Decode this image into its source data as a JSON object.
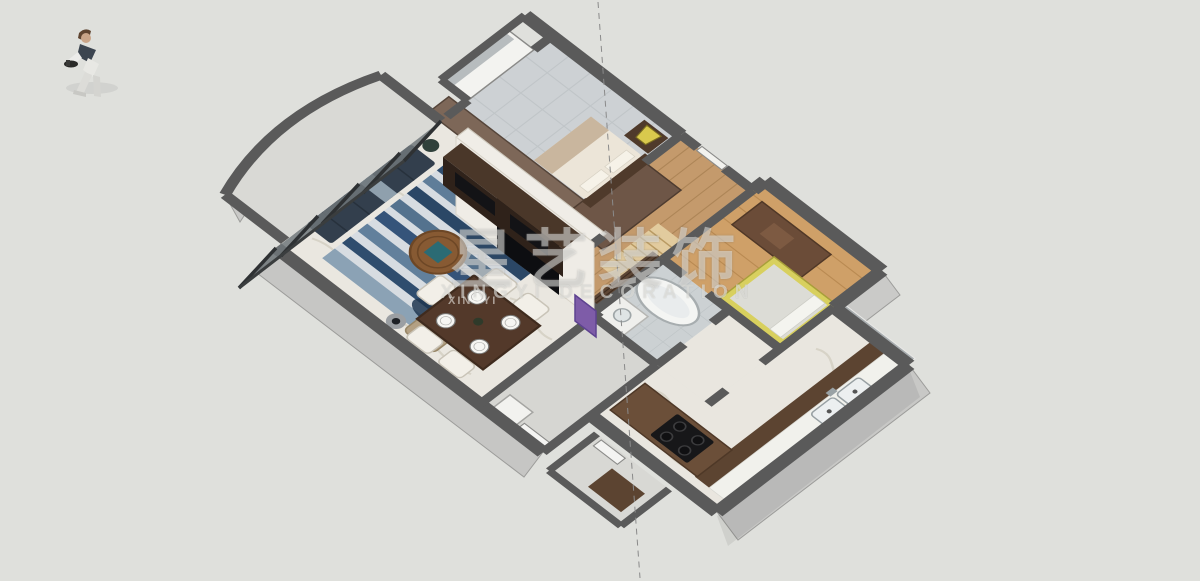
{
  "scene": {
    "type": "3d-apartment-cutaway-floorplan-render",
    "background": "#dfe0dc",
    "watermark": {
      "brand_cn": "星艺装饰",
      "brand_en": "XINGYI DECORATION",
      "small": "XINGYI"
    },
    "palette": {
      "wall_top": "#5a5a5a",
      "wall_face_light": "#c7c7c5",
      "glass": "#70777a",
      "floor_marble": "#eae7e0",
      "floor_wood": "#c99f6c",
      "floor_tile": "#cdd1d4",
      "rug_blue_dark": "#2b4766",
      "rug_blue_mid": "#5f7d99",
      "sofa_navy": "#333f4d",
      "cabinet_wood_dark": "#5c4431",
      "bulkhead_brown": "#7d6758",
      "counter_white": "#f1f1ec",
      "dining_table_wood": "#53392a",
      "tv_black": "#0d0e11",
      "lamp_yellow": "#d9c94d",
      "single_bed_yellow": "#d8d05e",
      "artwork_purple": "#7e5ca8",
      "coffee_table_wood": "#875a33"
    },
    "objects": [
      "person-figure",
      "master-bedroom",
      "small-bedroom",
      "entry-hall",
      "bathroom",
      "kitchen",
      "living-room",
      "dining-area",
      "curved-balcony",
      "utility-room",
      "service-balcony",
      "guide-line"
    ]
  }
}
